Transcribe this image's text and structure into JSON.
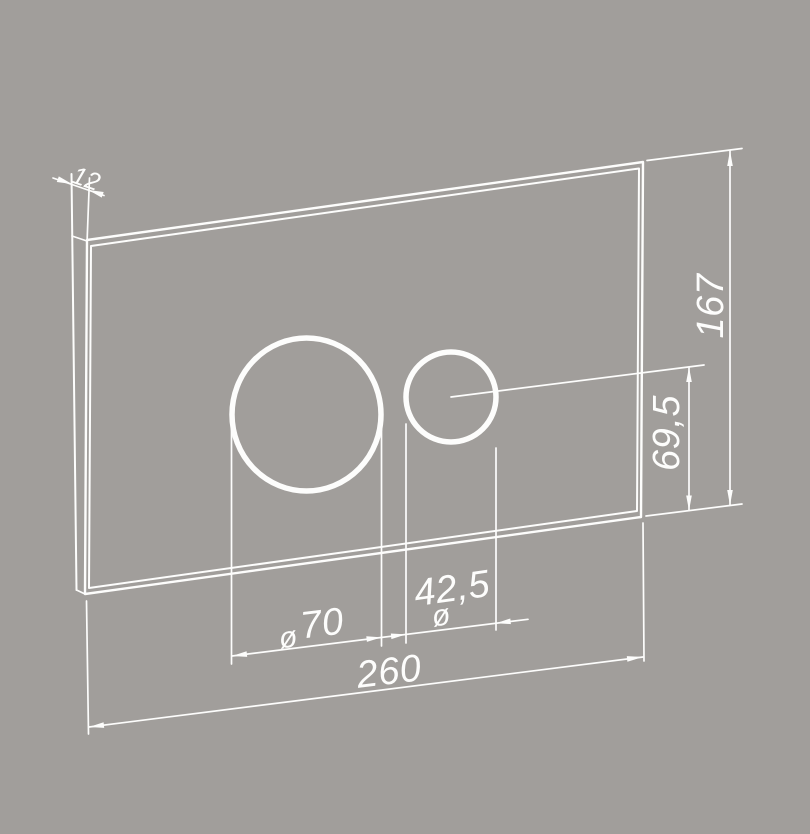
{
  "drawing": {
    "type": "technical-dimension-drawing",
    "subject": "wall flush plate front view with two actuator button circles",
    "colors": {
      "background": "#a19e9b",
      "line": "#fdfdfc"
    },
    "dimensions": {
      "width": "260",
      "height": "167",
      "thickness": "12",
      "button_center_offset": "69,5",
      "large_button_diameter": "70",
      "small_button_diameter": "42,5",
      "diameter_symbol": "ø"
    }
  }
}
